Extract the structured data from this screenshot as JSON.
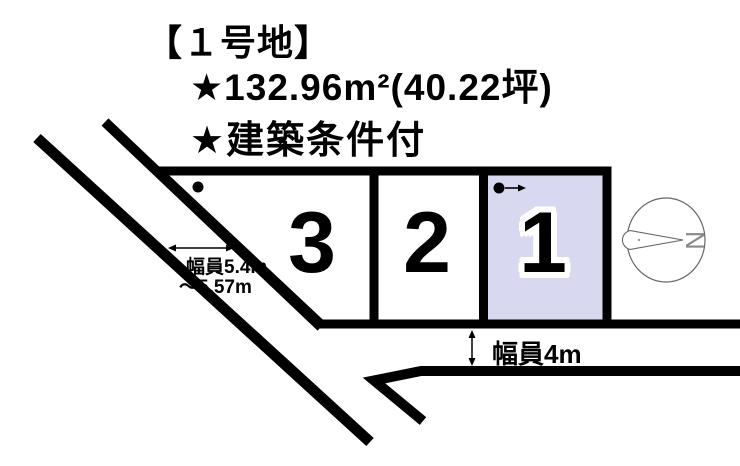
{
  "header": {
    "title": "【１号地】",
    "area_line": "★132.96m²(40.22坪)",
    "condition_line": "★建築条件付"
  },
  "lots": [
    {
      "label": "3",
      "fill": "#ffffff",
      "highlighted": false
    },
    {
      "label": "2",
      "fill": "#ffffff",
      "highlighted": false
    },
    {
      "label": "1",
      "fill": "#d8d8f1",
      "highlighted": true
    }
  ],
  "labels": {
    "left_road_width_line1": "幅員5.4m",
    "left_road_width_line2": "～5.57m",
    "bottom_road_width": "幅員4m"
  },
  "compass": {
    "letter": "N"
  },
  "colors": {
    "line": "#000000",
    "lot1_fill": "#d8d8f1",
    "compass_stroke": "#666666",
    "background": "#ffffff"
  }
}
